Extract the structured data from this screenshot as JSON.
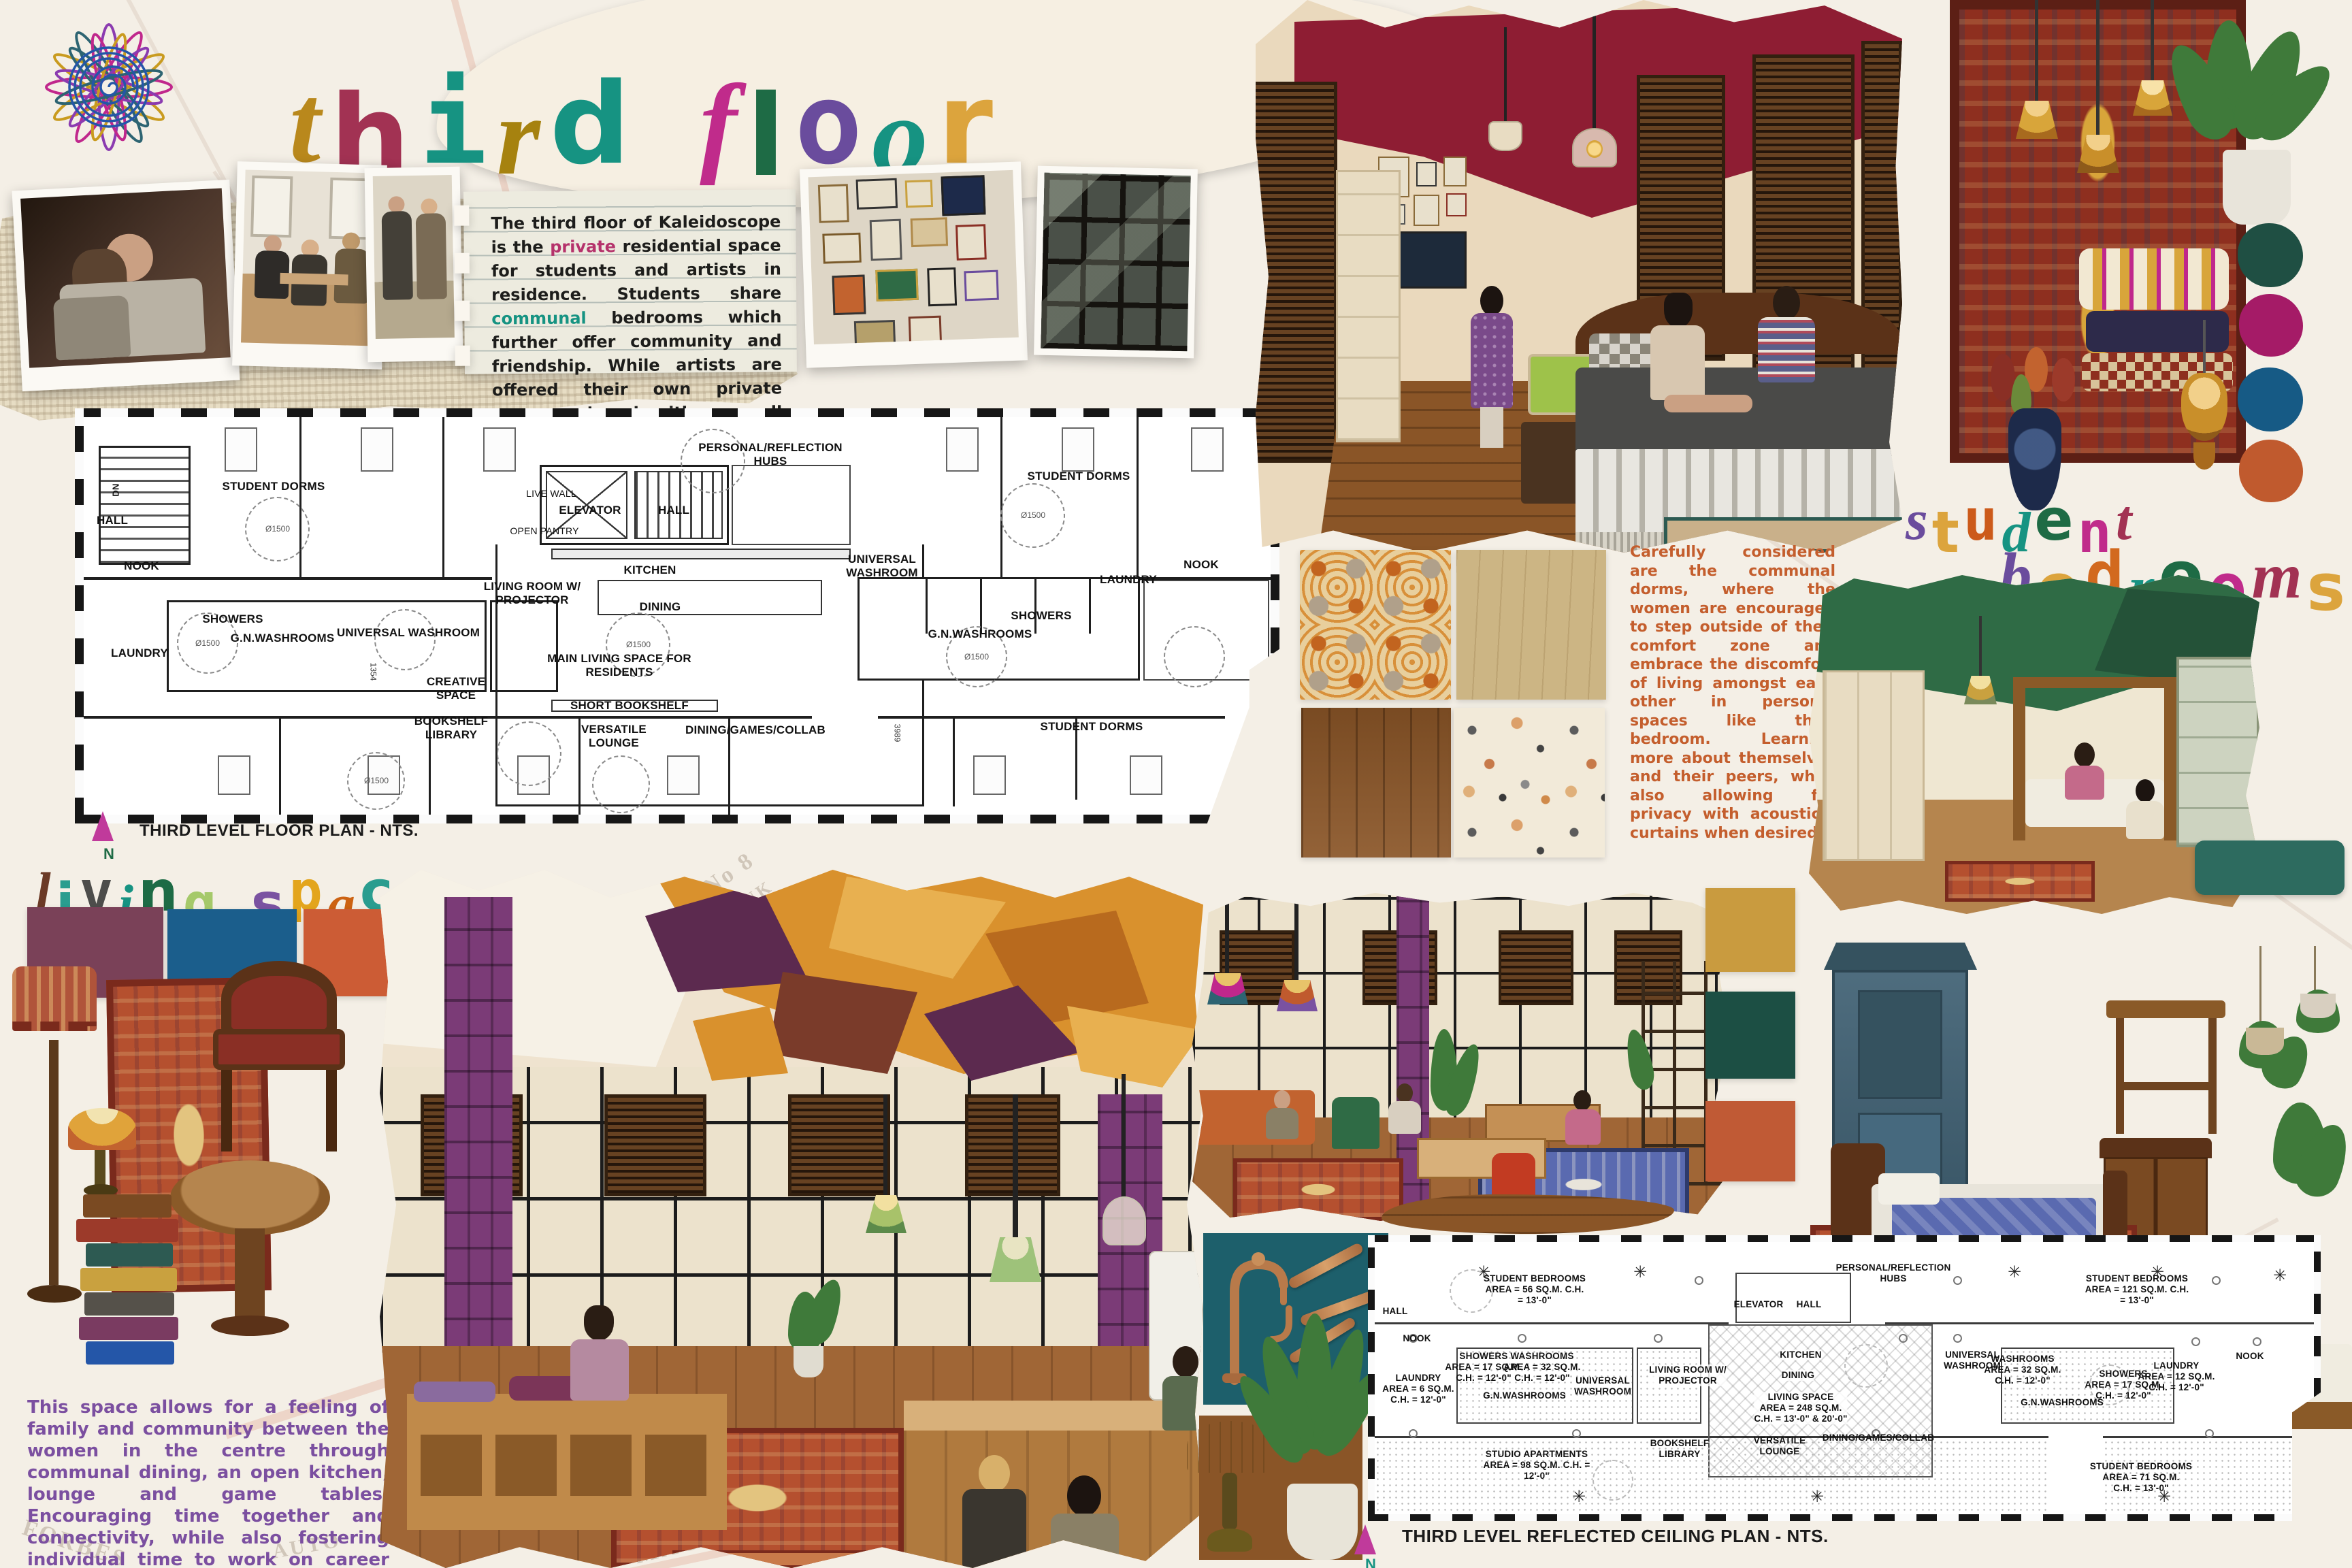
{
  "meta": {
    "board_name": "third floor design board"
  },
  "background": {
    "map_words": [
      "No 8",
      "OIL TANK",
      "INDEX",
      "MACHINE",
      "AUTO",
      "FORBES"
    ]
  },
  "title": {
    "letters": [
      {
        "ch": "t",
        "c": "#b9881c"
      },
      {
        "ch": "h",
        "c": "#a23253"
      },
      {
        "ch": "i",
        "c": "#169382"
      },
      {
        "ch": "r",
        "c": "#a6820f"
      },
      {
        "ch": "d",
        "c": "#169382"
      },
      {
        "ch": " ",
        "c": ""
      },
      {
        "ch": "f",
        "c": "#c02b8b"
      },
      {
        "ch": "l",
        "c": "#1e6b45"
      },
      {
        "ch": "o",
        "c": "#6a4c9d"
      },
      {
        "ch": "o",
        "c": "#169382"
      },
      {
        "ch": "r",
        "c": "#dca43d"
      }
    ]
  },
  "intro": {
    "segments": [
      {
        "t": "The third floor of Kaleidoscope is the "
      },
      {
        "t": "private",
        "c": "#b5326b"
      },
      {
        "t": " residential space for students and artists in residence. Students share "
      },
      {
        "t": "communal",
        "c": "#169382"
      },
      {
        "t": " bedrooms which further offer community and friendship. While artists are offered their own private rooms quipped with a small kitchen. The central communal lounge allows all residences to feel like they are in a "
      },
      {
        "t": "home",
        "c": "#e0761f"
      },
      {
        "t": " away from home!"
      }
    ]
  },
  "plan1": {
    "caption": "THIRD LEVEL FLOOR PLAN - NTS.",
    "north": "N",
    "turning_circle": "Ø1500",
    "labels": {
      "sd_top_left": "STUDENT DORMS",
      "sd_top_right": "STUDENT DORMS",
      "sd_bottom_right": "STUDENT DORMS",
      "hall_left": "HALL",
      "nook_left": "NOOK",
      "laundry_left": "LAUNDRY",
      "showers_left": "SHOWERS",
      "gn_washrooms_left": "G.N.WASHROOMS",
      "universal_washroom_left": "UNIVERSAL WASHROOM",
      "live_wall": "LIVE WALL",
      "elevator": "ELEVATOR",
      "hall_center": "HALL",
      "open_pantry": "OPEN PANTRY",
      "hubs": "PERSONAL/REFLECTION\nHUBS",
      "living_room": "LIVING ROOM W/\nPROJECTOR",
      "kitchen": "KITCHEN",
      "dining": "DINING",
      "main_living": "MAIN LIVING SPACE FOR\nRESIDENTS",
      "short_bookshelf": "SHORT BOOKSHELF",
      "creative_space": "CREATIVE\nSPACE",
      "bookshelf_library": "BOOKSHELF\nLIBRARY",
      "versatile_lounge": "VERSATILE\nLOUNGE",
      "dining_games": "DINING/GAMES/COLLAB",
      "universal_washroom_right": "UNIVERSAL\nWASHROOM",
      "laundry_right": "LAUNDRY",
      "gn_washrooms_right": "G.N.WASHROOMS",
      "showers_right": "SHOWERS",
      "nook_right": "NOOK",
      "dn": "DN",
      "dim_a": "1354",
      "dim_b": "3989"
    }
  },
  "living": {
    "letters": [
      {
        "ch": "l",
        "c": "#6b3a26"
      },
      {
        "ch": "i",
        "c": "#2a9d8f"
      },
      {
        "ch": "v",
        "c": "#4d4d4b"
      },
      {
        "ch": "i",
        "c": "#169382"
      },
      {
        "ch": "n",
        "c": "#1d6b45"
      },
      {
        "ch": "g",
        "c": "#a5c96a"
      },
      {
        "ch": " ",
        "c": ""
      },
      {
        "ch": "s",
        "c": "#7a52a1"
      },
      {
        "ch": "p",
        "c": "#e3a51d"
      },
      {
        "ch": "a",
        "c": "#cc6212"
      },
      {
        "ch": "c",
        "c": "#2a9d8f"
      },
      {
        "ch": "e",
        "c": "#1d6b45"
      }
    ],
    "paragraph": "This space allows for a feeling of family and community between the women in the centre through communal dining, an open kitchen, lounge and game tables. Encouraging time together and connectivity, while also fostering individual time to work on career goals, art, personal life, and self reflection in the hubs and smaller tables.."
  },
  "bedrooms": {
    "letters_line1": [
      {
        "ch": "s",
        "c": "#6a4c9d"
      },
      {
        "ch": "t",
        "c": "#dca43d"
      },
      {
        "ch": "u",
        "c": "#cc5a1a"
      },
      {
        "ch": "d",
        "c": "#169382"
      },
      {
        "ch": "e",
        "c": "#1e6b45"
      },
      {
        "ch": "n",
        "c": "#c02b8b"
      },
      {
        "ch": "t",
        "c": "#a23253"
      }
    ],
    "letters_line2": [
      {
        "ch": "b",
        "c": "#6a4c9d"
      },
      {
        "ch": "e",
        "c": "#dca43d"
      },
      {
        "ch": "d",
        "c": "#d2691e"
      },
      {
        "ch": "r",
        "c": "#169382"
      },
      {
        "ch": "o",
        "c": "#1e6b45"
      },
      {
        "ch": "o",
        "c": "#c02b8b"
      },
      {
        "ch": "m",
        "c": "#a23253"
      },
      {
        "ch": "s",
        "c": "#dca43d"
      }
    ],
    "paragraph": "Carefully considered are the communal dorms, where the women are encouraged to step outside of their comfort zone and embrace the discomfort of living amongst each other in personal spaces like their bedroom. Learning more about themselves and their peers, while also allowing for privacy with acoustical curtains when desired."
  },
  "plan2": {
    "caption": "THIRD LEVEL REFLECTED CEILING PLAN - NTS.",
    "north": "N",
    "labels": {
      "sb56": "STUDENT BEDROOMS\nAREA = 56 SQ.M. C.H.\n= 13'-0\"",
      "hall": "HALL",
      "nook": "NOOK",
      "laundry6": "LAUNDRY\nAREA = 6 SQ.M.\nC.H. = 12'-0\"",
      "showers17": "SHOWERS\nAREA = 17 SQ.M.\nC.H. = 12'-0\"",
      "washrooms32": "WASHROOMS\nAREA = 32 SQ.M.\nC.H. = 12'-0\"",
      "gn_left": "G.N.WASHROOMS",
      "universal_left": "UNIVERSAL\nWASHROOM",
      "studio98": "STUDIO APARTMENTS\nAREA = 98 SQ.M. C.H. =\n12'-0\"",
      "bookshelf": "BOOKSHELF\nLIBRARY",
      "living_room": "LIVING ROOM W/\nPROJECTOR",
      "hubs": "PERSONAL/REFLECTION\nHUBS",
      "elevator": "ELEVATOR",
      "hall_center": "HALL",
      "kitchen": "KITCHEN",
      "dining": "DINING",
      "living248": "LIVING SPACE\nAREA = 248 SQ.M.\nC.H. = 13'-0\" & 20'-0\"",
      "versatile": "VERSATILE\nLOUNGE",
      "dgc": "DINING/GAMES/COLLAB",
      "universal_right": "UNIVERSAL\nWASHROOM",
      "washrooms32_right": "WASHROOMS\nAREA = 32 SQ.M.\nC.H. = 12'-0\"",
      "gn_right": "G.N.WASHROOMS",
      "showers17_right": "SHOWERS\nAREA = 17 SQ.M.\nC.H. = 12'-0\"",
      "laundry12": "LAUNDRY\nAREA = 12 SQ.M.\nC.H. = 12'-0\"",
      "nook_right": "NOOK",
      "sb121": "STUDENT BEDROOMS\nAREA = 121 SQ.M. C.H.\n= 13'-0\"",
      "sb71": "STUDENT BEDROOMS\nAREA = 71 SQ.M.\nC.H. = 13'-0\""
    }
  },
  "palettes": {
    "circles": [
      "#1f4f43",
      "#a51b67",
      "#165a85",
      "#c05a2e"
    ],
    "living_rects": [
      "#7a4158",
      "#1b5e8c",
      "#cc5c35"
    ],
    "bedroom_rects": [
      "#c99b3f",
      "#1c4f44",
      "#c05a35"
    ]
  }
}
